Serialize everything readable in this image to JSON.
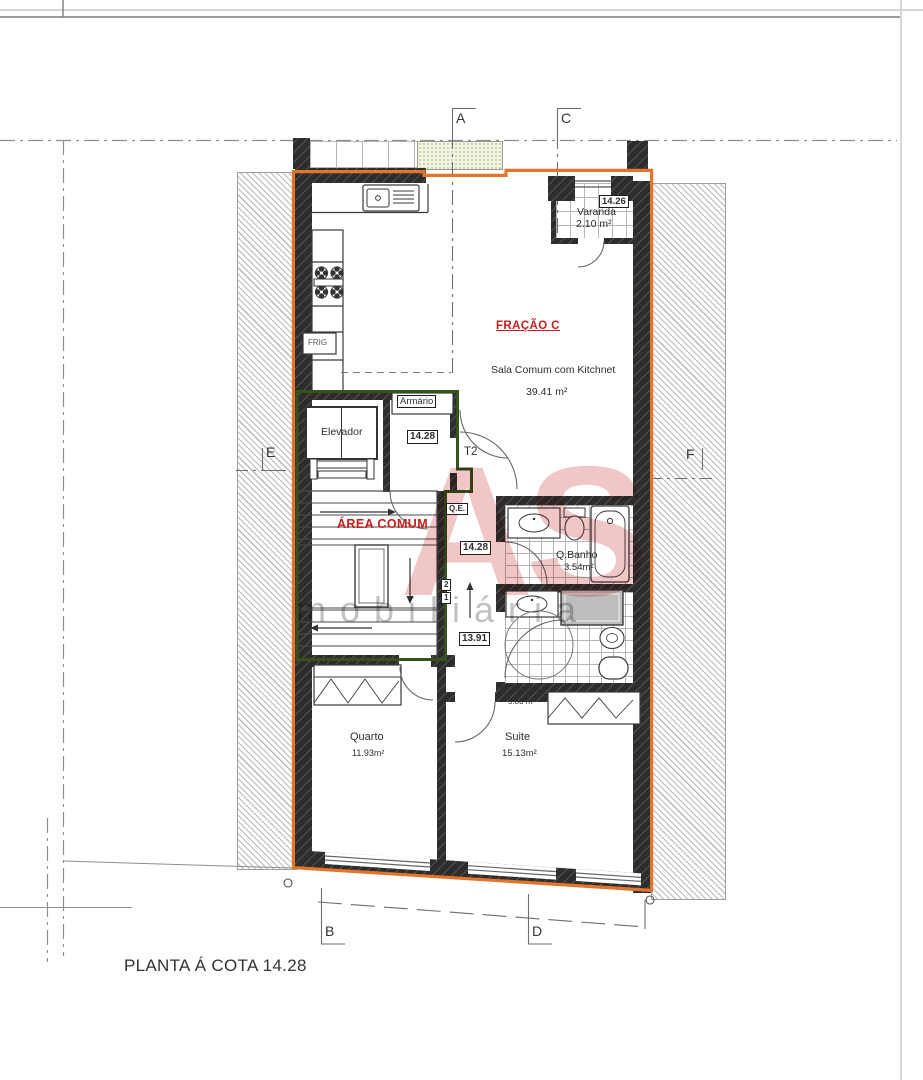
{
  "labels": {
    "frig": "FRIG",
    "fracao": "FRAÇÃO C",
    "sala_nome": "Sala Comum com Kitchnet",
    "sala_area": "39.41 m²",
    "varanda_cota": "14.26",
    "varanda_nome": "Varanda",
    "varanda_area": "2.10 m²",
    "elevador": "Elevador",
    "armario": "Armário",
    "hall_cota": "14.28",
    "tipologia": "T2",
    "area_comum": "ÁREA COMUM",
    "qe": "Q.E.",
    "patamar_cota": "14.28",
    "degrau2": "2",
    "degrau1": "1",
    "cota_baixa": "13.91",
    "banho1_nome": "Q.Banho",
    "banho1_area": "3.54m²",
    "banho2_nome": "Q.Banho",
    "banho2_area": "5.83 m²",
    "quarto_nome": "Quarto",
    "quarto_area": "11.93m²",
    "suite_nome": "Suite",
    "suite_area": "15.13m²",
    "title": "PLANTA Á COTA 14.28"
  },
  "grid": {
    "a": "A",
    "b": "B",
    "c": "C",
    "d": "D",
    "e": "E",
    "f": "F"
  },
  "watermark": {
    "initials": "AS",
    "word": "mobiliária"
  },
  "colors": {
    "fraction_outline": "#e2742c",
    "common_outline": "#36521c",
    "label_red": "#c41d1d",
    "wall": "#2e2d2c",
    "watermark_red": "rgba(205,65,70,0.30)"
  }
}
